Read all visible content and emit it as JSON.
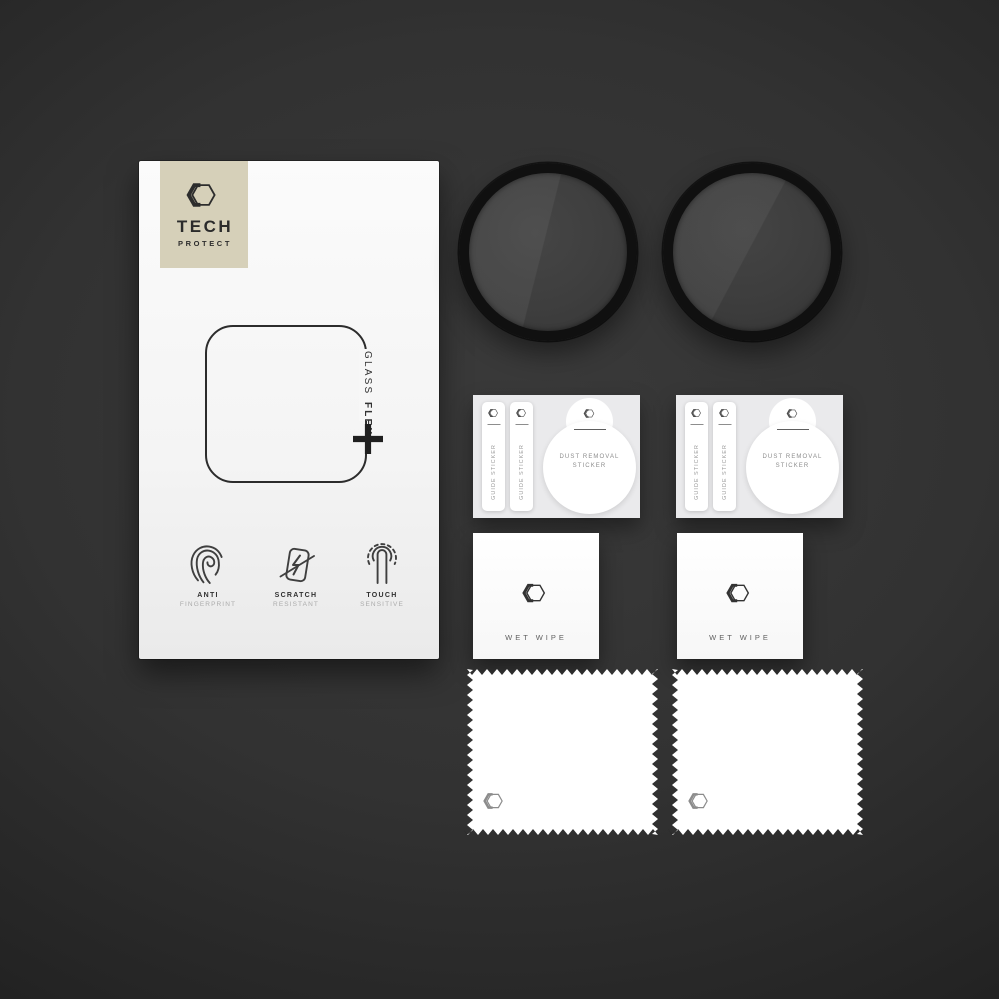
{
  "colors": {
    "background_center": "#3a3a3a",
    "background_edge": "#121212",
    "badge": "#d6d0b9",
    "box": "#f7f7f7",
    "glass_ring": "#101010"
  },
  "package": {
    "brand": {
      "name_top": "TECH",
      "name_bottom": "PROTECT"
    },
    "product_line": {
      "word1": "GLASS",
      "word2": "FLEX"
    },
    "features": [
      {
        "icon": "fingerprint-icon",
        "line1": "ANTI",
        "line2": "FINGERPRINT"
      },
      {
        "icon": "scratch-resistant-icon",
        "line1": "SCRATCH",
        "line2": "RESISTANT"
      },
      {
        "icon": "touch-sensitive-icon",
        "line1": "TOUCH",
        "line2": "SENSITIVE"
      }
    ]
  },
  "accessories": {
    "glass_discs": {
      "count": 2
    },
    "sticker_sheets": {
      "count": 2,
      "guide_sticker_label": "GUIDE STICKER",
      "dust_removal_line1": "DUST REMOVAL",
      "dust_removal_line2": "STICKER"
    },
    "wet_wipes": {
      "count": 2,
      "label": "WET WIPE"
    },
    "microfiber_cloths": {
      "count": 2
    }
  }
}
